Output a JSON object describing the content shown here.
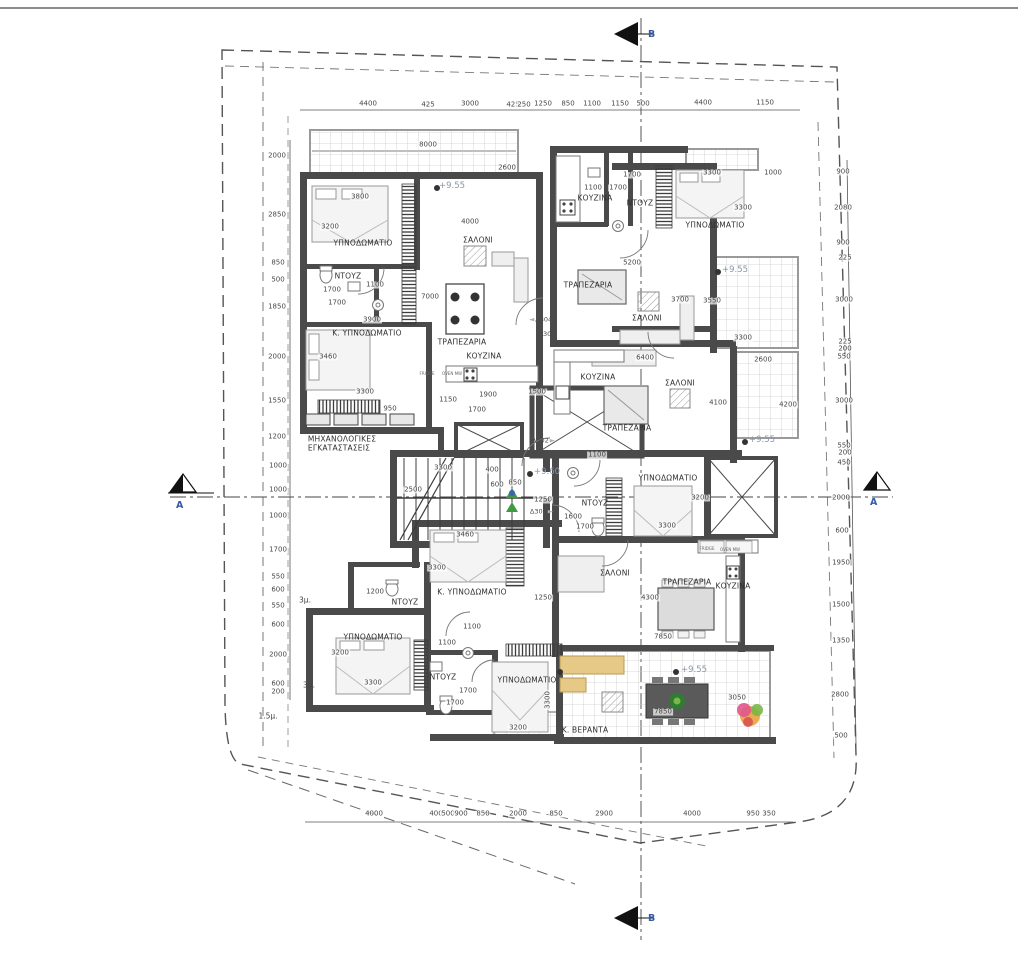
{
  "section_markers": {
    "top": {
      "letter": "B"
    },
    "bottom": {
      "letter": "B"
    },
    "left": {
      "letter": "A"
    },
    "right": {
      "letter": "A"
    }
  },
  "colors": {
    "wall": "#4a4a4a",
    "veranda_grid": "#cccccc",
    "dim_text": "#474747",
    "room_text": "#2f2f2f",
    "elevation_text": "#8a96a8",
    "section_letter": "#3558a8",
    "plant_green": "#2e7d32",
    "sofa_tan": "#e6c887",
    "flower_pink": "#e0558a",
    "flower_orange": "#e8a33d"
  },
  "rooms": [
    {
      "text": "ΥΠΝΟΔΩΜΑΤΙΟ",
      "x": 363,
      "y": 243
    },
    {
      "text": "ΣΑΛΟΝΙ",
      "x": 478,
      "y": 240
    },
    {
      "text": "ΝΤΟΥΖ",
      "x": 348,
      "y": 276
    },
    {
      "text": "Κ. ΥΠΝΟΔΩΜΑΤΙΟ",
      "x": 367,
      "y": 333
    },
    {
      "text": "ΤΡΑΠΕΖΑΡΙΑ",
      "x": 462,
      "y": 342
    },
    {
      "text": "ΚΟΥΖΙΝΑ",
      "x": 484,
      "y": 356
    },
    {
      "text": "ΜΗΧΑΝΟΛΟΓΙΚΕΣ",
      "x": 342,
      "y": 439
    },
    {
      "text": "ΕΓΚΑΤΑΣΤΑΣΕΙΣ",
      "x": 339,
      "y": 448
    },
    {
      "text": "ΚΟΥΖΙΝΑ",
      "x": 595,
      "y": 198
    },
    {
      "text": "ΝΤΟΥΖ",
      "x": 640,
      "y": 203
    },
    {
      "text": "ΥΠΝΟΔΩΜΑΤΙΟ",
      "x": 715,
      "y": 225
    },
    {
      "text": "ΤΡΑΠΕΖΑΡΙΑ",
      "x": 588,
      "y": 285
    },
    {
      "text": "ΣΑΛΟΝΙ",
      "x": 647,
      "y": 318
    },
    {
      "text": "ΚΟΥΖΙΝΑ",
      "x": 598,
      "y": 377
    },
    {
      "text": "ΣΑΛΟΝΙ",
      "x": 680,
      "y": 383
    },
    {
      "text": "ΤΡΑΠΕΖΑΡΙΑ",
      "x": 627,
      "y": 428
    },
    {
      "text": "ΥΠΝΟΔΩΜΑΤΙΟ",
      "x": 668,
      "y": 478
    },
    {
      "text": "ΝΤΟΥΖ",
      "x": 595,
      "y": 503
    },
    {
      "text": "Κ. ΥΠΝΟΔΩΜΑΤΙΟ",
      "x": 472,
      "y": 592
    },
    {
      "text": "ΝΤΟΥΖ",
      "x": 405,
      "y": 602
    },
    {
      "text": "ΥΠΝΟΔΩΜΑΤΙΟ",
      "x": 373,
      "y": 637
    },
    {
      "text": "ΝΤΟΥΖ",
      "x": 443,
      "y": 677
    },
    {
      "text": "ΥΠΝΟΔΩΜΑΤΙΟ",
      "x": 527,
      "y": 680
    },
    {
      "text": "ΣΑΛΟΝΙ",
      "x": 615,
      "y": 573
    },
    {
      "text": "ΤΡΑΠΕΖΑΡΙΑ",
      "x": 687,
      "y": 582
    },
    {
      "text": "ΚΟΥΖΙΝΑ",
      "x": 733,
      "y": 586
    },
    {
      "text": "Κ. ΒΕΡΑΝΤΑ",
      "x": 585,
      "y": 730
    }
  ],
  "elevations": [
    {
      "text": "+9.55",
      "x": 452,
      "y": 186
    },
    {
      "text": "+9.55",
      "x": 735,
      "y": 270
    },
    {
      "text": "+9.55",
      "x": 762,
      "y": 440
    },
    {
      "text": "+9.55",
      "x": 694,
      "y": 670
    },
    {
      "text": "+9.60",
      "x": 547,
      "y": 472
    }
  ],
  "door_tags": [
    {
      "text": "Δ304",
      "x": 540,
      "y": 320,
      "arrow": "left"
    },
    {
      "text": "Δ301",
      "x": 547,
      "y": 334
    },
    {
      "text": "Δ302",
      "x": 544,
      "y": 441,
      "arrow": "right"
    },
    {
      "text": "Δ303",
      "x": 542,
      "y": 512,
      "arrow": "right"
    }
  ],
  "appliances": [
    {
      "text": "FRIDGE",
      "x": 707,
      "y": 549
    },
    {
      "text": "OVEN MW",
      "x": 730,
      "y": 550
    },
    {
      "text": "FRIDGE",
      "x": 427,
      "y": 374
    },
    {
      "text": "OVEN MW",
      "x": 452,
      "y": 374
    }
  ],
  "setbacks": [
    {
      "text": "3μ.",
      "x": 305,
      "y": 600
    },
    {
      "text": "3μ.",
      "x": 309,
      "y": 685
    },
    {
      "text": "1.5μ.",
      "x": 268,
      "y": 716
    }
  ],
  "dims_top": [
    {
      "text": "4400",
      "x": 368,
      "y": 104
    },
    {
      "text": "425",
      "x": 428,
      "y": 105
    },
    {
      "text": "3000",
      "x": 470,
      "y": 104
    },
    {
      "text": "425",
      "x": 513,
      "y": 105
    },
    {
      "text": "250",
      "x": 524,
      "y": 105
    },
    {
      "text": "1250",
      "x": 543,
      "y": 104
    },
    {
      "text": "850",
      "x": 568,
      "y": 104
    },
    {
      "text": "1100",
      "x": 592,
      "y": 104
    },
    {
      "text": "1150",
      "x": 620,
      "y": 104
    },
    {
      "text": "500",
      "x": 643,
      "y": 104
    },
    {
      "text": "4400",
      "x": 703,
      "y": 103
    },
    {
      "text": "1150",
      "x": 765,
      "y": 103
    }
  ],
  "dims_bottom": [
    {
      "text": "4000",
      "x": 374,
      "y": 814
    },
    {
      "text": "400",
      "x": 436,
      "y": 814
    },
    {
      "text": "500",
      "x": 448,
      "y": 814
    },
    {
      "text": "900",
      "x": 461,
      "y": 814
    },
    {
      "text": "850",
      "x": 483,
      "y": 814
    },
    {
      "text": "2000",
      "x": 518,
      "y": 814
    },
    {
      "text": "850",
      "x": 556,
      "y": 814
    },
    {
      "text": "2900",
      "x": 604,
      "y": 814
    },
    {
      "text": "4000",
      "x": 692,
      "y": 814
    },
    {
      "text": "950",
      "x": 753,
      "y": 814
    },
    {
      "text": "350",
      "x": 769,
      "y": 814
    }
  ],
  "dims_left": [
    {
      "text": "2000",
      "x": 277,
      "y": 156
    },
    {
      "text": "2850",
      "x": 277,
      "y": 215
    },
    {
      "text": "850",
      "x": 278,
      "y": 263
    },
    {
      "text": "500",
      "x": 278,
      "y": 280
    },
    {
      "text": "1850",
      "x": 277,
      "y": 307
    },
    {
      "text": "2000",
      "x": 277,
      "y": 357
    },
    {
      "text": "1550",
      "x": 277,
      "y": 401
    },
    {
      "text": "1200",
      "x": 277,
      "y": 437
    },
    {
      "text": "1000",
      "x": 278,
      "y": 466
    },
    {
      "text": "1000",
      "x": 278,
      "y": 490
    },
    {
      "text": "1000",
      "x": 278,
      "y": 516
    },
    {
      "text": "1700",
      "x": 278,
      "y": 550
    },
    {
      "text": "550",
      "x": 278,
      "y": 577
    },
    {
      "text": "600",
      "x": 278,
      "y": 590
    },
    {
      "text": "550",
      "x": 278,
      "y": 606
    },
    {
      "text": "600",
      "x": 278,
      "y": 625
    },
    {
      "text": "2000",
      "x": 278,
      "y": 655
    },
    {
      "text": "600",
      "x": 278,
      "y": 684
    },
    {
      "text": "200",
      "x": 278,
      "y": 692
    }
  ],
  "dims_right": [
    {
      "text": "900",
      "x": 843,
      "y": 172
    },
    {
      "text": "2080",
      "x": 843,
      "y": 208
    },
    {
      "text": "900",
      "x": 843,
      "y": 243
    },
    {
      "text": "225",
      "x": 845,
      "y": 258
    },
    {
      "text": "3000",
      "x": 844,
      "y": 300
    },
    {
      "text": "225",
      "x": 845,
      "y": 342
    },
    {
      "text": "200",
      "x": 845,
      "y": 349
    },
    {
      "text": "550",
      "x": 844,
      "y": 357
    },
    {
      "text": "3000",
      "x": 844,
      "y": 401
    },
    {
      "text": "550",
      "x": 844,
      "y": 446
    },
    {
      "text": "200",
      "x": 845,
      "y": 453
    },
    {
      "text": "450",
      "x": 844,
      "y": 463
    },
    {
      "text": "2000",
      "x": 841,
      "y": 498
    },
    {
      "text": "600",
      "x": 842,
      "y": 531
    },
    {
      "text": "1950",
      "x": 841,
      "y": 563
    },
    {
      "text": "1500",
      "x": 841,
      "y": 605
    },
    {
      "text": "1350",
      "x": 841,
      "y": 641
    },
    {
      "text": "2800",
      "x": 840,
      "y": 695
    },
    {
      "text": "500",
      "x": 841,
      "y": 736
    }
  ],
  "dims_interior": [
    {
      "text": "8000",
      "x": 428,
      "y": 145
    },
    {
      "text": "2600",
      "x": 507,
      "y": 168
    },
    {
      "text": "3800",
      "x": 360,
      "y": 197
    },
    {
      "text": "3200",
      "x": 330,
      "y": 227
    },
    {
      "text": "4000",
      "x": 470,
      "y": 222
    },
    {
      "text": "1100",
      "x": 375,
      "y": 285
    },
    {
      "text": "1700",
      "x": 332,
      "y": 290
    },
    {
      "text": "1700",
      "x": 337,
      "y": 303
    },
    {
      "text": "3900",
      "x": 372,
      "y": 320
    },
    {
      "text": "7000",
      "x": 430,
      "y": 297
    },
    {
      "text": "3460",
      "x": 328,
      "y": 357
    },
    {
      "text": "3300",
      "x": 365,
      "y": 392
    },
    {
      "text": "950",
      "x": 390,
      "y": 409
    },
    {
      "text": "1150",
      "x": 448,
      "y": 400
    },
    {
      "text": "1700",
      "x": 477,
      "y": 410
    },
    {
      "text": "1900",
      "x": 488,
      "y": 395
    },
    {
      "text": "1500",
      "x": 537,
      "y": 392
    },
    {
      "text": "1700",
      "x": 632,
      "y": 175
    },
    {
      "text": "3300",
      "x": 712,
      "y": 173
    },
    {
      "text": "1000",
      "x": 773,
      "y": 173
    },
    {
      "text": "1100",
      "x": 593,
      "y": 188
    },
    {
      "text": "1700",
      "x": 618,
      "y": 188
    },
    {
      "text": "3300",
      "x": 743,
      "y": 208
    },
    {
      "text": "5200",
      "x": 632,
      "y": 263
    },
    {
      "text": "3700",
      "x": 680,
      "y": 300
    },
    {
      "text": "3550",
      "x": 712,
      "y": 301
    },
    {
      "text": "3300",
      "x": 743,
      "y": 338
    },
    {
      "text": "6400",
      "x": 645,
      "y": 358
    },
    {
      "text": "2600",
      "x": 763,
      "y": 360
    },
    {
      "text": "4100",
      "x": 718,
      "y": 403
    },
    {
      "text": "4200",
      "x": 788,
      "y": 405
    },
    {
      "text": "3300",
      "x": 443,
      "y": 468
    },
    {
      "text": "400",
      "x": 492,
      "y": 470
    },
    {
      "text": "2500",
      "x": 413,
      "y": 490
    },
    {
      "text": "600",
      "x": 497,
      "y": 485
    },
    {
      "text": "850",
      "x": 515,
      "y": 483
    },
    {
      "text": "1250",
      "x": 543,
      "y": 500
    },
    {
      "text": "1100",
      "x": 597,
      "y": 455
    },
    {
      "text": "1600",
      "x": 573,
      "y": 517
    },
    {
      "text": "1700",
      "x": 585,
      "y": 527
    },
    {
      "text": "3460",
      "x": 465,
      "y": 535
    },
    {
      "text": "3300",
      "x": 437,
      "y": 568
    },
    {
      "text": "3200",
      "x": 700,
      "y": 498
    },
    {
      "text": "3300",
      "x": 667,
      "y": 526
    },
    {
      "text": "1250",
      "x": 543,
      "y": 598
    },
    {
      "text": "1200",
      "x": 375,
      "y": 592
    },
    {
      "text": "1100",
      "x": 472,
      "y": 627
    },
    {
      "text": "1100",
      "x": 447,
      "y": 643
    },
    {
      "text": "3200",
      "x": 340,
      "y": 653
    },
    {
      "text": "3300",
      "x": 373,
      "y": 683
    },
    {
      "text": "1700",
      "x": 468,
      "y": 691
    },
    {
      "text": "1700",
      "x": 455,
      "y": 703
    },
    {
      "text": "3200",
      "x": 518,
      "y": 728
    },
    {
      "text": "3300",
      "x": 548,
      "y": 700,
      "rot": -90
    },
    {
      "text": "4300",
      "x": 650,
      "y": 598
    },
    {
      "text": "7850",
      "x": 663,
      "y": 637
    },
    {
      "text": "7850",
      "x": 663,
      "y": 712
    },
    {
      "text": "3050",
      "x": 737,
      "y": 698
    }
  ]
}
